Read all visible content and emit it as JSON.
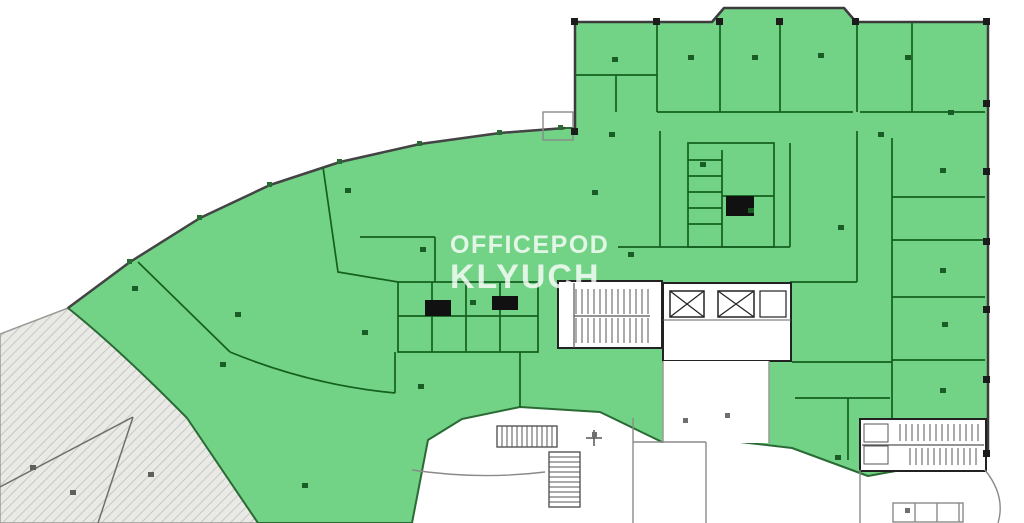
{
  "watermark": {
    "line1": "OFFICEPOD",
    "line2": "KLYUCH"
  },
  "plan": {
    "type": "floor-plan",
    "highlight_color": "#72d286",
    "highlight_wall_color": "#15601f",
    "outer_wall_color": "#3c3c3c",
    "terrace_fill": "#e9e9e6",
    "terrace_hatch": "#c6c6c3",
    "terrace_line_color": "#6f6f6c",
    "core_wall_color": "#222222",
    "neighbor_wall_color": "#8a8a88",
    "areas": [
      {
        "name": "leased-area",
        "style": "green-highlight"
      },
      {
        "name": "terrace-band",
        "style": "gray-hatch"
      },
      {
        "name": "bay-window",
        "style": "green-highlight"
      },
      {
        "name": "stair-core-main",
        "style": "white-core"
      },
      {
        "name": "elevator-core",
        "style": "white-core"
      },
      {
        "name": "stair-core-southeast",
        "style": "white-core"
      },
      {
        "name": "stair-neighbor-south",
        "style": "neighbor"
      },
      {
        "name": "neighbor-premises",
        "style": "neighbor"
      }
    ]
  },
  "markers": {
    "room-labels": [
      [
        345,
        188
      ],
      [
        132,
        286
      ],
      [
        235,
        312
      ],
      [
        362,
        330
      ],
      [
        420,
        247
      ],
      [
        418,
        384
      ],
      [
        302,
        483
      ],
      [
        220,
        362
      ],
      [
        612,
        57
      ],
      [
        688,
        55
      ],
      [
        752,
        55
      ],
      [
        818,
        53
      ],
      [
        905,
        55
      ],
      [
        948,
        110
      ],
      [
        592,
        190
      ],
      [
        628,
        252
      ],
      [
        700,
        162
      ],
      [
        748,
        208
      ],
      [
        838,
        225
      ],
      [
        940,
        168
      ],
      [
        940,
        268
      ],
      [
        942,
        322
      ],
      [
        940,
        388
      ],
      [
        835,
        455
      ],
      [
        878,
        132
      ],
      [
        609,
        132
      ],
      [
        470,
        300
      ]
    ],
    "columns": [
      [
        571,
        18
      ],
      [
        653,
        18
      ],
      [
        716,
        18
      ],
      [
        776,
        18
      ],
      [
        852,
        18
      ],
      [
        983,
        18
      ],
      [
        983,
        100
      ],
      [
        983,
        168
      ],
      [
        983,
        238
      ],
      [
        983,
        306
      ],
      [
        983,
        376
      ],
      [
        983,
        450
      ],
      [
        571,
        128
      ]
    ],
    "window-ticks": [
      [
        127,
        259
      ],
      [
        197,
        215
      ],
      [
        267,
        182
      ],
      [
        337,
        159
      ],
      [
        417,
        141
      ],
      [
        497,
        130
      ],
      [
        558,
        125
      ]
    ],
    "terrace-labels": [
      [
        30,
        465
      ],
      [
        70,
        490
      ],
      [
        148,
        472
      ]
    ],
    "neighbor-labels": [
      [
        592,
        432
      ],
      [
        683,
        418
      ],
      [
        725,
        413
      ],
      [
        905,
        508
      ]
    ]
  },
  "marker_styles": {
    "room-labels": {
      "w": 6,
      "h": 5,
      "color": "#1a5c26",
      "name": "room-number-mark"
    },
    "columns": {
      "w": 7,
      "h": 7,
      "color": "#1c1c1c",
      "name": "column-marker"
    },
    "window-ticks": {
      "w": 5,
      "h": 5,
      "color": "#2a6b35",
      "name": "window-tick"
    },
    "terrace-labels": {
      "w": 6,
      "h": 5,
      "color": "#5f5f5c",
      "name": "terrace-label-mark"
    },
    "neighbor-labels": {
      "w": 5,
      "h": 5,
      "color": "#6f6f6c",
      "name": "neighbor-label-mark"
    }
  }
}
